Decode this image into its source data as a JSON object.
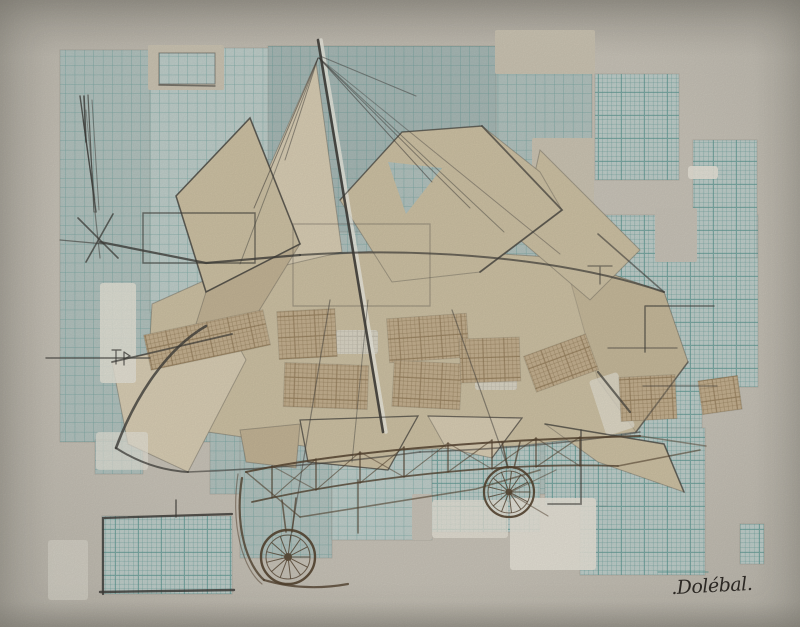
{
  "artwork": {
    "medium": "Mixed-media collage photograph: pencil and sepia ink drawing of an early flying machine over pasted graph-paper fragments on textured paper",
    "subject": "Early aeroplane with kite-like paper sails, rigging mast, lattice fuselage truss and two spoked wheels",
    "signature": ".Dolébal."
  },
  "palette": {
    "paper_bg": "#c6c1b6",
    "paper_beige": "#c9c2b1",
    "gesso_white": "#e3e0d5",
    "tones": [
      "#bdccc8",
      "#b1c1bd",
      "#a6b7b4"
    ],
    "teal_line": "#4e8f8a",
    "fine_line": "#57948e",
    "brown_fill": "#c2ae8e",
    "brown_line": "#8a7452",
    "whitegrid_fill": "#dcd9cd",
    "whitegrid_line": "#b7b2a4",
    "beige": "#cbbfa2",
    "beigeLight": "#d6cbb2",
    "beigeDark": "#c1b294",
    "pencil": "#3f3d39",
    "pencil_white": "#e9e7dd",
    "sepia": "#53422f",
    "ink": "#2f2b26"
  },
  "scene": {
    "width": 800,
    "height": 627,
    "patterns": {
      "coarse": {
        "cell": 9.4,
        "lw": 0.8,
        "lo": 0.6
      },
      "fine": {
        "cell": 4.6,
        "major": 23,
        "lw": 0.5,
        "lo": 0.5,
        "mlw": 1.0,
        "mlo": 0.65
      },
      "brown": {
        "cell": 4.2,
        "major": 21,
        "lw": 0.5,
        "lo": 0.6,
        "mlw": 0.9,
        "mlo": 0.7
      },
      "whitegrid": {
        "cell": 4.2,
        "major": 21,
        "lw": 0.5,
        "lo": 0.8,
        "mlw": 0.9,
        "mlo": 0.8
      }
    },
    "patches": [
      {
        "x": 60,
        "y": 50,
        "w": 152,
        "h": 392,
        "p": "coarse",
        "t": 1
      },
      {
        "x": 95,
        "y": 440,
        "w": 48,
        "h": 34,
        "p": "coarse",
        "t": 1
      },
      {
        "x": 150,
        "y": 48,
        "w": 168,
        "h": 264,
        "p": "coarse",
        "t": 0
      },
      {
        "x": 268,
        "y": 46,
        "w": 232,
        "h": 192,
        "p": "coarse",
        "t": 2
      },
      {
        "x": 496,
        "y": 72,
        "w": 96,
        "h": 166,
        "p": "coarse",
        "t": 1
      },
      {
        "x": 210,
        "y": 232,
        "w": 345,
        "h": 262,
        "p": "coarse",
        "t": 1
      },
      {
        "x": 545,
        "y": 215,
        "w": 213,
        "h": 172,
        "p": "fine",
        "t": 0
      },
      {
        "x": 545,
        "y": 385,
        "w": 157,
        "h": 46,
        "p": "fine",
        "t": 0
      },
      {
        "x": 595,
        "y": 74,
        "w": 84,
        "h": 106,
        "p": "fine",
        "t": 0
      },
      {
        "x": 693,
        "y": 140,
        "w": 64,
        "h": 118,
        "p": "fine",
        "t": 0
      },
      {
        "x": 580,
        "y": 428,
        "w": 125,
        "h": 147,
        "p": "fine",
        "t": 0
      },
      {
        "x": 545,
        "y": 428,
        "w": 62,
        "h": 78,
        "p": "fine",
        "t": 0
      },
      {
        "x": 240,
        "y": 428,
        "w": 92,
        "h": 130,
        "p": "coarse",
        "t": 1
      },
      {
        "x": 332,
        "y": 428,
        "w": 100,
        "h": 112,
        "p": "coarse",
        "t": 0
      },
      {
        "x": 432,
        "y": 428,
        "w": 108,
        "h": 104,
        "p": "fine",
        "t": 0
      },
      {
        "x": 102,
        "y": 516,
        "w": 130,
        "h": 78,
        "p": "fine",
        "t": 0
      },
      {
        "x": 740,
        "y": 524,
        "w": 24,
        "h": 40,
        "p": "fine",
        "t": 0
      }
    ],
    "cutouts": [
      {
        "x": 148,
        "y": 45,
        "w": 76,
        "h": 45,
        "f": "paper_beige"
      },
      {
        "x": 655,
        "y": 208,
        "w": 42,
        "h": 54,
        "f": "paper_bg"
      },
      {
        "x": 495,
        "y": 30,
        "w": 100,
        "h": 44,
        "f": "paper_beige"
      },
      {
        "x": 532,
        "y": 138,
        "w": 62,
        "h": 80,
        "f": "paper_beige"
      },
      {
        "x": 412,
        "y": 494,
        "w": 20,
        "h": 46,
        "f": "paper_bg"
      }
    ],
    "overlay_patches": [
      {
        "x": 159,
        "y": 53,
        "w": 56,
        "h": 31,
        "p": "coarse",
        "t": 0
      }
    ],
    "sails": [
      {
        "pts": "152,304 246,262 410,248 564,258 664,292 688,362 636,432 516,446 344,452 208,432 148,372",
        "f": "beige"
      },
      {
        "pts": "564,258 664,292 688,362 636,432 598,380",
        "f": "beigeDark",
        "o": 0.6
      },
      {
        "pts": "540,150 640,250 590,300 520,240",
        "f": "beige"
      },
      {
        "pts": "340,200 402,132 482,126 540,172 562,210 480,272 392,282",
        "f": "beige"
      },
      {
        "pts": "388,162 442,168 406,214",
        "f": "gap"
      },
      {
        "pts": "268,170 316,62 342,252 282,266",
        "f": "beigeLight"
      },
      {
        "pts": "176,196 250,118 300,244 206,292",
        "f": "beige"
      },
      {
        "pts": "206,292 300,244 246,332 196,324",
        "f": "beigeDark"
      },
      {
        "pts": "112,362 232,334 246,360 188,472 128,444",
        "f": "beigeLight"
      },
      {
        "pts": "300,420 418,416 388,470 308,462",
        "f": "beige"
      },
      {
        "pts": "428,416 522,418 492,458 446,448",
        "f": "beigeLight"
      },
      {
        "pts": "545,424 664,444 684,492 598,462",
        "f": "beige"
      },
      {
        "pts": "240,430 300,424 296,468 246,462",
        "f": "beigeDark"
      }
    ],
    "accents": [
      {
        "x": 100,
        "y": 283,
        "w": 36,
        "h": 100,
        "o": 0.85
      },
      {
        "x": 432,
        "y": 500,
        "w": 76,
        "h": 38,
        "o": 0.8
      },
      {
        "x": 510,
        "y": 498,
        "w": 86,
        "h": 72,
        "o": 0.9
      },
      {
        "x": 688,
        "y": 166,
        "w": 30,
        "h": 13,
        "o": 0.9
      },
      {
        "x": 48,
        "y": 540,
        "w": 40,
        "h": 60,
        "o": 0.45
      },
      {
        "x": 96,
        "y": 432,
        "w": 52,
        "h": 38,
        "o": 0.7
      },
      {
        "x": 597,
        "y": 375,
        "w": 30,
        "h": 58,
        "o": 0.65,
        "rot": -18
      },
      {
        "x": 336,
        "y": 330,
        "w": 42,
        "h": 24,
        "o": 0.75,
        "grid": true
      },
      {
        "x": 475,
        "y": 352,
        "w": 42,
        "h": 38,
        "o": 0.75,
        "grid": true
      }
    ],
    "brown_patches": [
      {
        "x": 146,
        "y": 322,
        "w": 122,
        "h": 36,
        "rot": -12
      },
      {
        "x": 278,
        "y": 310,
        "w": 58,
        "h": 48,
        "rot": -3
      },
      {
        "x": 284,
        "y": 364,
        "w": 84,
        "h": 44,
        "rot": 2
      },
      {
        "x": 388,
        "y": 316,
        "w": 80,
        "h": 44,
        "rot": -4
      },
      {
        "x": 393,
        "y": 362,
        "w": 68,
        "h": 46,
        "rot": 3
      },
      {
        "x": 460,
        "y": 338,
        "w": 60,
        "h": 44,
        "rot": -2
      },
      {
        "x": 528,
        "y": 344,
        "w": 66,
        "h": 38,
        "rot": -20
      },
      {
        "x": 620,
        "y": 376,
        "w": 56,
        "h": 44,
        "rot": -3
      },
      {
        "x": 700,
        "y": 378,
        "w": 40,
        "h": 34,
        "rot": -8
      }
    ],
    "pencil_lines": [
      {
        "d": "M321,40 L386,432",
        "w": 3.5,
        "o": 0.8,
        "c": "pencil_white"
      },
      {
        "d": "M318,40 L383,432",
        "w": 2.6,
        "o": 0.9
      },
      {
        "d": "M319,58 L432,182",
        "w": 1,
        "o": 0.55
      },
      {
        "d": "M319,58 L470,208",
        "w": 1,
        "o": 0.5
      },
      {
        "d": "M319,58 L504,232",
        "w": 1,
        "o": 0.45
      },
      {
        "d": "M319,58 L560,254",
        "w": 1,
        "o": 0.4
      },
      {
        "d": "M320,56 L416,96",
        "w": 1,
        "o": 0.5
      },
      {
        "d": "M318,58 L254,208",
        "w": 1,
        "o": 0.55
      },
      {
        "d": "M318,58 L240,264",
        "w": 1,
        "o": 0.45
      },
      {
        "d": "M318,58 L285,160",
        "w": 1,
        "o": 0.5
      },
      {
        "d": "M80,96 L96,212",
        "w": 1.4,
        "o": 0.8
      },
      {
        "d": "M88,95 L94,212",
        "w": 1.2,
        "o": 0.7
      },
      {
        "d": "M84,96 L86,142",
        "w": 1.6,
        "o": 0.8
      },
      {
        "d": "M92,100 L99,210",
        "w": 1,
        "o": 0.5
      },
      {
        "d": "M83,120 L93,190 M86,110 L95,200",
        "w": 1,
        "o": 0.4
      },
      {
        "d": "M78,218 L118,258",
        "w": 1.6,
        "o": 0.75
      },
      {
        "d": "M113,214 L86,262",
        "w": 1.6,
        "o": 0.75
      },
      {
        "d": "M95,212 L100,258",
        "w": 1.2,
        "o": 0.5
      },
      {
        "d": "M46,358 L150,358",
        "w": 1.4,
        "o": 0.7
      },
      {
        "d": "M60,240 L104,244",
        "w": 1.2,
        "o": 0.6
      },
      {
        "d": "M116,350 L116,364 M112,350 L121,350 M124,352 L124,365 M124,352 L130,356 L124,359",
        "w": 1.2,
        "o": 0.8
      },
      {
        "d": "M143,213 H255 V263 H143 Z",
        "w": 1.4,
        "o": 0.65
      },
      {
        "d": "M293,224 H430 V306 H293 Z",
        "w": 1.2,
        "o": 0.3
      },
      {
        "d": "M588,266 L612,266 M600,266 L600,284",
        "w": 1.3,
        "o": 0.6
      },
      {
        "d": "M645,306 L714,306 M645,306 L645,352",
        "w": 1.5,
        "o": 0.65
      },
      {
        "d": "M608,348 L677,348",
        "w": 1.3,
        "o": 0.55
      },
      {
        "d": "M643,386 L717,386",
        "w": 1.3,
        "o": 0.5
      },
      {
        "d": "M103,594 L103,518 L232,514",
        "w": 2.2,
        "o": 0.85
      },
      {
        "d": "M100,592 L234,590",
        "w": 2.4,
        "o": 0.85
      },
      {
        "d": "M176,500 L176,517",
        "w": 1.6,
        "o": 0.7
      },
      {
        "d": "M581,430 L581,504 L548,504",
        "w": 1.8,
        "o": 0.6
      },
      {
        "d": "M159,85 L215,86",
        "w": 1.5,
        "o": 0.6
      },
      {
        "d": "M159,53 H215 V84 H159 Z",
        "w": 1,
        "o": 0.4
      },
      {
        "d": "M100,242 L206,263 L300,255",
        "w": 2.2,
        "o": 0.8
      },
      {
        "d": "M300,255 C420,247 560,257 664,292",
        "w": 2,
        "o": 0.7
      },
      {
        "d": "M206,326 C168,348 136,394 116,448",
        "w": 2.6,
        "o": 0.8
      },
      {
        "d": "M116,448 Q150,470 188,472",
        "w": 2,
        "o": 0.75
      },
      {
        "d": "M188,472 Q300,468 420,452",
        "w": 1.6,
        "o": 0.6
      },
      {
        "d": "M420,452 Q540,448 640,432",
        "w": 1.6,
        "o": 0.55
      },
      {
        "d": "M112,362 L232,334",
        "w": 1.8,
        "o": 0.7
      },
      {
        "d": "M176,196 L250,118 L300,244 L206,292 Z",
        "w": 1.6,
        "o": 0.7
      },
      {
        "d": "M340,200 L402,132 L482,126",
        "w": 1.4,
        "o": 0.6
      },
      {
        "d": "M482,126 L562,210 L480,272",
        "w": 1.8,
        "o": 0.7
      },
      {
        "d": "M545,424 L664,444 L684,492",
        "w": 1.6,
        "o": 0.65
      },
      {
        "d": "M598,372 L630,412",
        "w": 2.2,
        "o": 0.7
      },
      {
        "d": "M598,234 L664,292",
        "w": 1.6,
        "o": 0.6
      },
      {
        "d": "M688,362 L636,432",
        "w": 1.6,
        "o": 0.5
      },
      {
        "d": "M330,300 L290,542",
        "w": 1.2,
        "o": 0.5
      },
      {
        "d": "M368,300 L352,462",
        "w": 1,
        "o": 0.45
      },
      {
        "d": "M452,310 L508,468",
        "w": 1.2,
        "o": 0.5
      },
      {
        "d": "M300,420 L418,416 L388,470 L308,462 Z",
        "w": 1.3,
        "o": 0.6
      },
      {
        "d": "M428,416 L522,418 L492,458",
        "w": 1.3,
        "o": 0.55
      },
      {
        "d": "M658,572 L708,572",
        "w": 1.4,
        "o": 0.5,
        "c": "teal_line"
      }
    ],
    "sepia_lines": [
      {
        "d": "M246,472 C340,452 480,440 640,436",
        "w": 2,
        "o": 0.85
      },
      {
        "d": "M252,502 C360,478 500,462 618,466",
        "w": 1.8,
        "o": 0.8
      },
      {
        "d": "M272,466 L272,498 M316,459 L316,490 M360,452 L360,483 M404,447 L404,477 M448,443 L448,472 M492,440 L492,469 M536,438 L536,467 M580,437 L580,466",
        "w": 1.4,
        "o": 0.75
      },
      {
        "d": "M358,480 L358,533",
        "w": 1.4,
        "o": 0.7
      },
      {
        "d": "M272,498 L316,459 M316,490 L360,452 M360,483 L404,447 M404,477 L448,443 M448,472 L492,440 M492,469 L536,438 M536,467 L580,437",
        "w": 1.1,
        "o": 0.6
      },
      {
        "d": "M272,466 L316,490 M360,452 L404,477 M448,443 L492,469 M536,438 L580,466",
        "w": 1.1,
        "o": 0.5
      },
      {
        "d": "M300,517 L476,489 L540,470",
        "w": 1.6,
        "o": 0.6
      },
      {
        "d": "M242,478 C234,528 248,566 264,580",
        "w": 2.2,
        "o": 0.8
      },
      {
        "d": "M264,580 Q304,592 348,584",
        "w": 2.2,
        "o": 0.8
      },
      {
        "d": "M238,474 C230,528 244,570 262,584",
        "w": 1.2,
        "o": 0.5
      },
      {
        "d": "M282,500 L286,532 M296,498 L292,532",
        "w": 1.6,
        "o": 0.7
      },
      {
        "d": "M502,442 L508,468 M520,442 L514,468",
        "w": 1.6,
        "o": 0.7
      },
      {
        "d": "M618,466 L700,450",
        "w": 1.6,
        "o": 0.6
      },
      {
        "d": "M640,436 L706,446",
        "w": 1.4,
        "o": 0.5
      },
      {
        "d": "M509,493 L556,470 M509,493 L548,516",
        "w": 1.2,
        "o": 0.5
      },
      {
        "d": "M246,472 L300,517",
        "w": 1.4,
        "o": 0.6
      }
    ],
    "wheels": [
      {
        "cx": 288,
        "cy": 557,
        "r": 27,
        "ir": 22,
        "hub": 4,
        "sp": 13,
        "w": 2.4
      },
      {
        "cx": 509,
        "cy": 492,
        "r": 25,
        "ir": 21,
        "hub": 3.5,
        "sp": 13,
        "w": 2.2
      }
    ],
    "signature_pos": {
      "x": 712,
      "y": 592,
      "size": 19,
      "rot": -3
    }
  }
}
